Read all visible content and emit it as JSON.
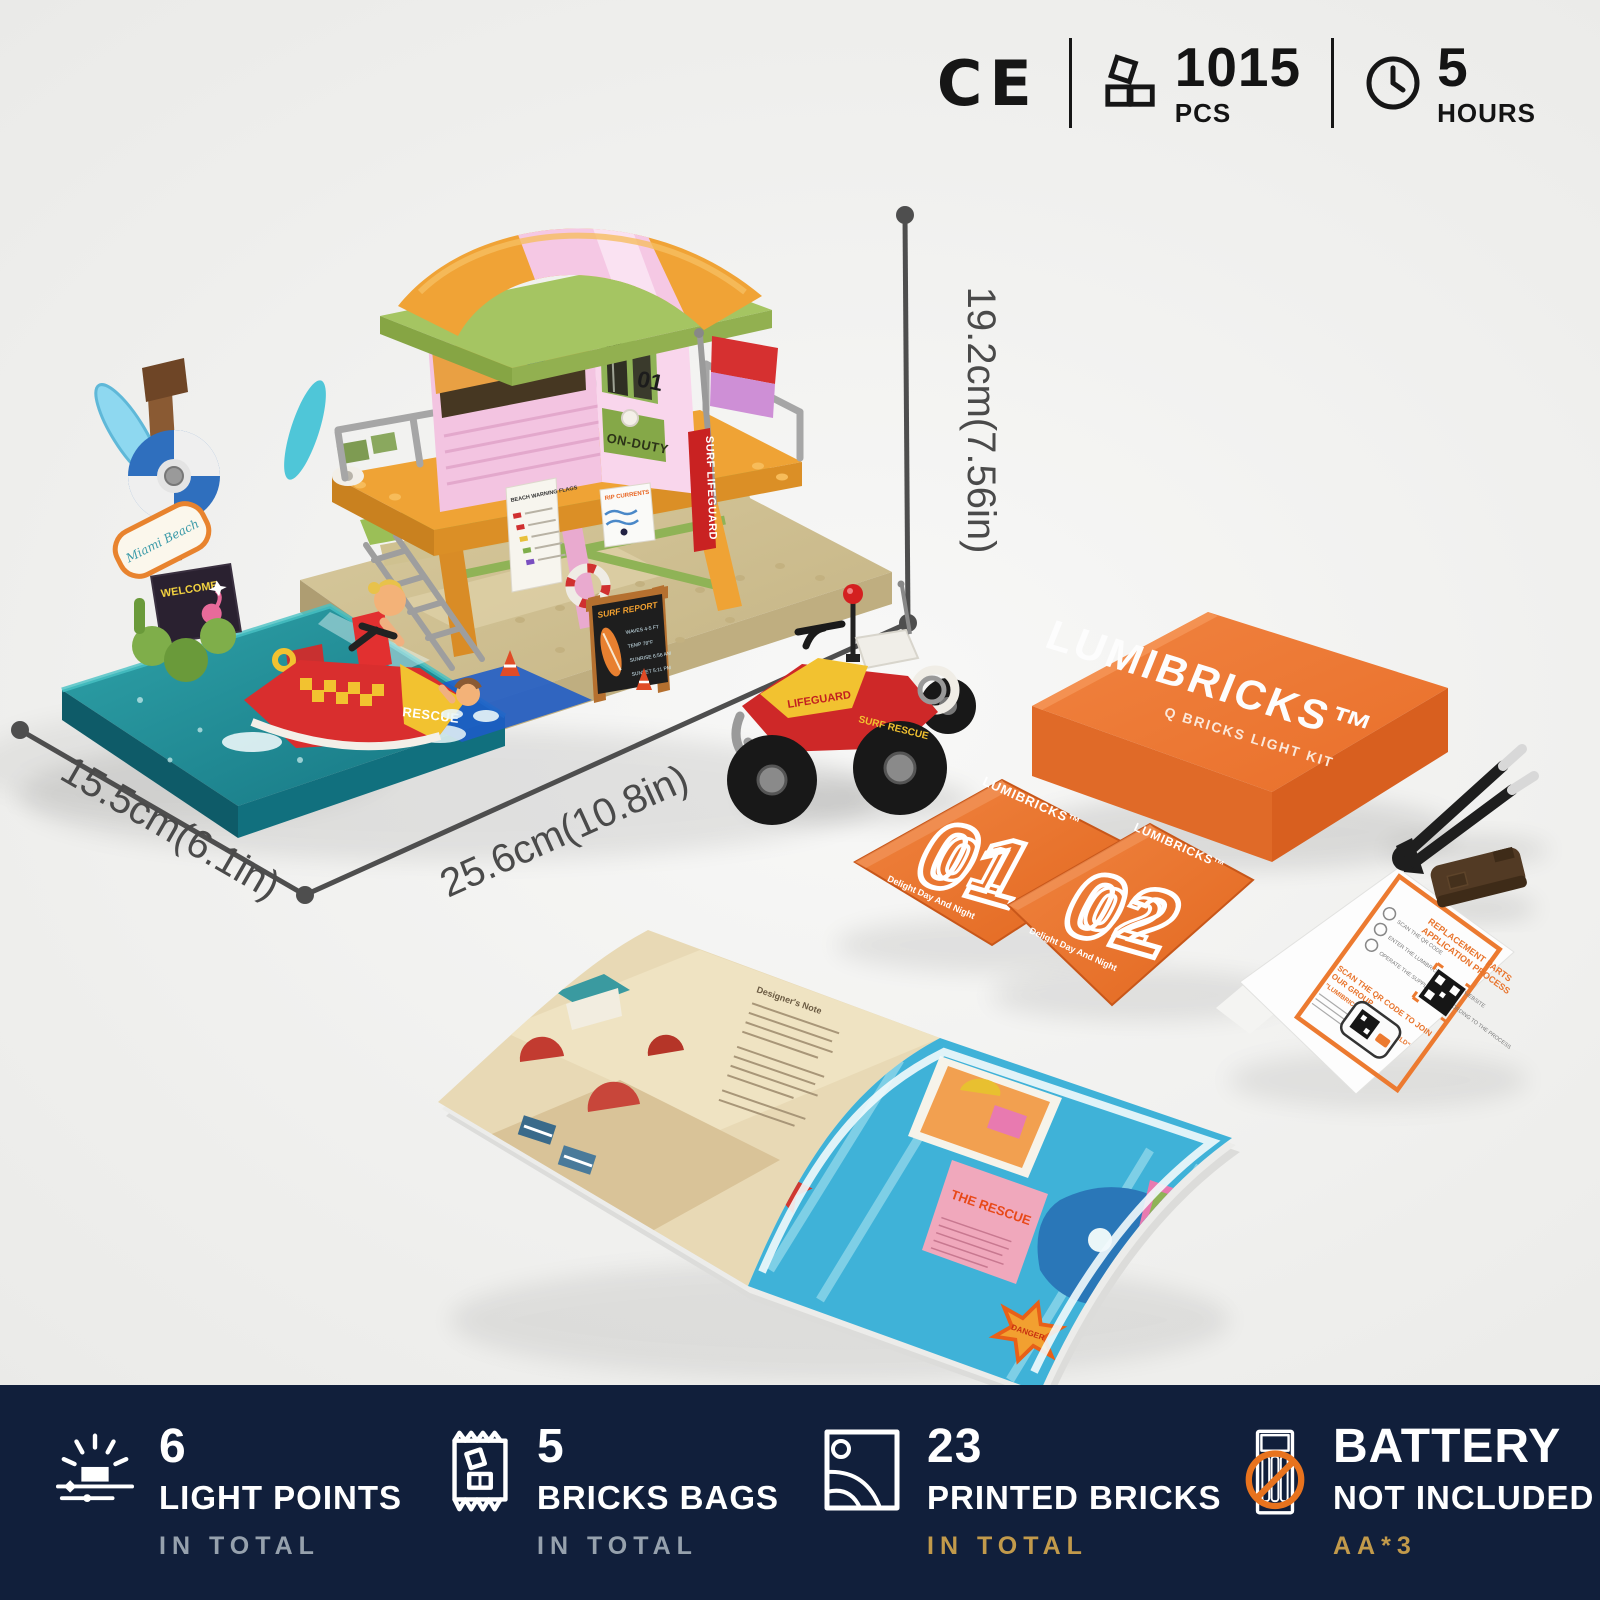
{
  "badges": {
    "ce_label": "CE",
    "pieces_value": "1015",
    "pieces_unit": "PCS",
    "time_value": "5",
    "time_unit": "HOURS"
  },
  "dimensions": {
    "height_label": "19.2cm(7.56in)",
    "width_label": "15.5cm(6.1in)",
    "depth_label": "25.6cm(10.8in)"
  },
  "model": {
    "tower_number": "01",
    "on_duty_sign": "ON-DUTY",
    "surf_lifeguard_sign": "SURF LIFEGUARD",
    "beach_warning_sign": "BEACH WARNING FLAGS",
    "rip_currents_sign": "RIP CURRENTS",
    "welcome_sign": "WELCOME",
    "beach_board_sign": "Miami Beach",
    "jetski_label": "RESCUE",
    "atv_hood_label": "LIFEGUARD",
    "atv_side_label": "SURF RESCUE",
    "surf_report": {
      "title": "SURF REPORT",
      "lines": [
        "WAVES  4-5 FT",
        "TEMP  78°F",
        "SUNRISE  6:56 AM",
        "SUNSET  5:11 PM"
      ]
    }
  },
  "box": {
    "brand": "LUMIBRICKS™",
    "subtitle": "Q BRICKS LIGHT KIT"
  },
  "bags": [
    {
      "brand": "LUMIBRICKS™",
      "number": "01",
      "tagline": "Delight Day And Night"
    },
    {
      "brand": "LUMIBRICKS™",
      "number": "02",
      "tagline": "Delight Day And Night"
    }
  ],
  "manual": {
    "left_page_heading": "Designer's Note",
    "right_page_title": "THE RESCUE",
    "right_page_badge": "DANGER"
  },
  "card": {
    "title_lines": [
      "REPLACEMENT PARTS",
      "APPLICATION PROCESS"
    ],
    "steps": [
      "SCAN THE QR CODE",
      "ENTER THE LUMIBRICKS OFFICIAL WEBSITE",
      "OPERATE THE SUPPLEMENT ACCORDING TO THE PROCESS"
    ],
    "join_lines": [
      "SCAN THE QR CODE TO JOIN",
      "OUR GROUP"
    ],
    "join_subtitle": "\"LUMIBRICKS DELIGHT WORLD\""
  },
  "features": [
    {
      "value": "6",
      "label": "LIGHT POINTS",
      "note": "IN TOTAL",
      "icon": "light-points-icon"
    },
    {
      "value": "5",
      "label": "BRICKS BAGS",
      "note": "IN TOTAL",
      "icon": "bricks-bag-icon"
    },
    {
      "value": "23",
      "label": "PRINTED BRICKS",
      "note": "IN TOTAL",
      "icon": "printed-bricks-icon"
    },
    {
      "value": "BATTERY",
      "label": "NOT INCLUDED",
      "note": "AA*3",
      "icon": "battery-icon"
    }
  ],
  "colors": {
    "bar_navy": "#111F3B",
    "accent_orange": "#ED7A33",
    "gold": "#C29A4B",
    "note_gray": "#96A1AD",
    "dimension_gray": "#4E4E4E"
  }
}
